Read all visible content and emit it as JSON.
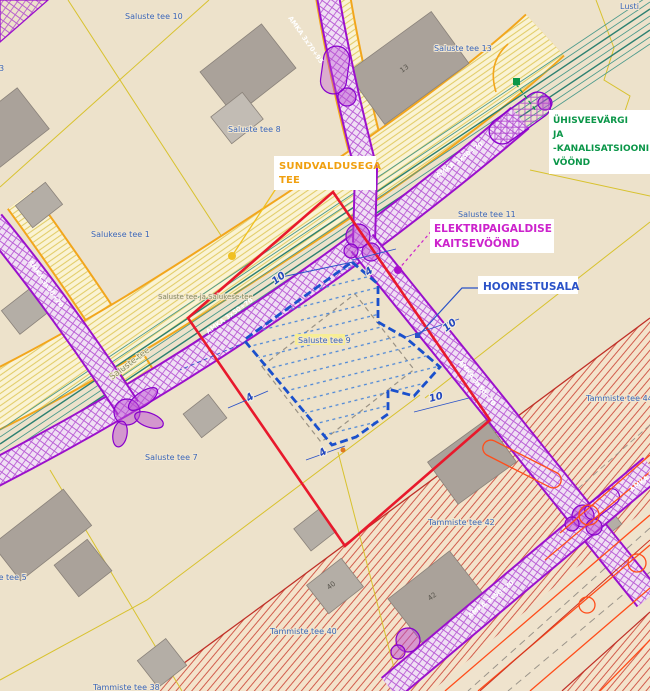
{
  "annotations": {
    "sundvaldusega": {
      "line1": "SUNDVALDUSEGA",
      "line2": "TEE"
    },
    "veevark": {
      "line1": "ÜHISVEEVÄRGI",
      "line2": "JA",
      "line3": "-KANALISATSIOONI",
      "line4": "VÖÖND"
    },
    "elekter": {
      "line1": "ELEKTRIPAIGALDISE",
      "line2": "KAITSEVÖÖND"
    },
    "hoonestusala": {
      "label": "HOONESTUSALA"
    }
  },
  "parcels": {
    "p0": "Saluste tee 10",
    "p1": "Saluste tee 13",
    "p2": "Saluste tee 8",
    "p3": "Salukese tee 1",
    "p4": "Saluste tee 11",
    "p5": "Saluste tee 9",
    "p6": "Saluste tee 7",
    "p7": "Saluste tee 5",
    "p8": "Tammiste tee 44",
    "p9": "Tammiste tee 42",
    "p10": "Tammiste tee 40",
    "p11": "Tammiste tee 38",
    "p12": "Lusti",
    "p13": "3",
    "p14": "Saluste tee ja Salukese tee"
  },
  "roads": {
    "saluste": "Saluste tee"
  },
  "cables": {
    "c0": "AMKA 3x70+95",
    "c1": "AMKA 3x50+70",
    "c2": "AMKA 3x50+70",
    "c3": "AMKA 3x50+70",
    "c4": "AMKA 3x50+70",
    "c5": "AMKA 3x50+70",
    "c6": "AMKA 3x50+70"
  },
  "buildings": {
    "b13": "13",
    "b42": "42",
    "b40": "40"
  },
  "dimensions": {
    "d0": "10",
    "d1": "4",
    "d2": "10",
    "d3": "10",
    "d4": "4",
    "d5": "4"
  },
  "colors": {
    "plan_boundary": "#e8192c",
    "hoonestusala": "#1a50cc",
    "elektri_zone": "#cc22cc",
    "vee_zone": "#0a9648",
    "sundvaldus_tee": "#f0a010",
    "cable_band": "#9b10cc",
    "road_edge": "#f2a61c",
    "red_zone_hatch": "#cc4433",
    "parcel_line": "#d8c22e",
    "parcel_label": "#3a66b8"
  }
}
